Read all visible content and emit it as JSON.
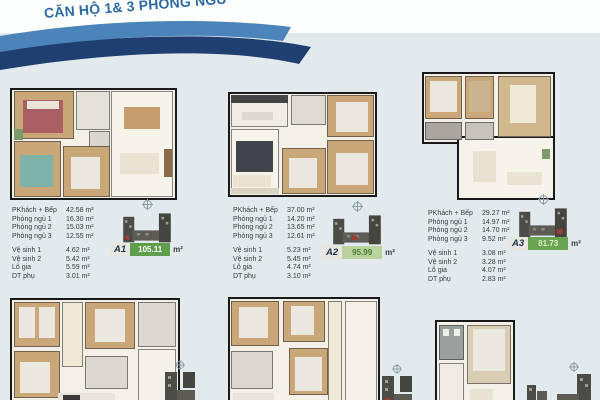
{
  "page": {
    "title": "CĂN HỘ 1& 3 PHÒNG NGỦ",
    "background": "#e2eaee",
    "title_color": "#2d6ba3",
    "ribbon_light": "#4b84ba",
    "ribbon_dark": "#1e3f70"
  },
  "units": [
    {
      "code": "A1",
      "total": "105.11",
      "unit": "m²",
      "badge_bg": "#5f9e4a",
      "badge_fg": "#ffffff",
      "specs": [
        {
          "label": "PKhách + Bếp",
          "value": "42.58 m²"
        },
        {
          "label": "Phòng ngủ 1",
          "value": "16.30 m²"
        },
        {
          "label": "Phòng ngủ 2",
          "value": "15.03 m²"
        },
        {
          "label": "Phòng ngủ 3",
          "value": "12.55 m²"
        },
        {
          "label": "Vệ sinh 1",
          "value": "4.62 m²"
        },
        {
          "label": "Vệ sinh 2",
          "value": "5.42 m²"
        },
        {
          "label": "Lô gia",
          "value": "5.59 m²"
        },
        {
          "label": "DT phụ",
          "value": "3.01 m²"
        }
      ]
    },
    {
      "code": "A2",
      "total": "95.99",
      "unit": "m²",
      "badge_bg": "#b9d29e",
      "badge_fg": "#47813a",
      "specs": [
        {
          "label": "PKhách + Bếp",
          "value": "37.00 m²"
        },
        {
          "label": "Phòng ngủ 1",
          "value": "14.20 m²"
        },
        {
          "label": "Phòng ngủ 2",
          "value": "13.65 m²"
        },
        {
          "label": "Phòng ngủ 3",
          "value": "12.61 m²"
        },
        {
          "label": "Vệ sinh 1",
          "value": "5.23 m²"
        },
        {
          "label": "Vệ sinh 2",
          "value": "5.45 m²"
        },
        {
          "label": "Lô gia",
          "value": "4.74 m²"
        },
        {
          "label": "DT phụ",
          "value": "3.10 m²"
        }
      ]
    },
    {
      "code": "A3",
      "total": "81.73",
      "unit": "m²",
      "badge_bg": "#6ba553",
      "badge_fg": "#d9ecc6",
      "specs": [
        {
          "label": "PKhách + Bếp",
          "value": "29.27 m²"
        },
        {
          "label": "Phòng ngủ 1",
          "value": "14.97 m²"
        },
        {
          "label": "Phòng ngủ 2",
          "value": "14.70 m²"
        },
        {
          "label": "Phòng ngủ 3",
          "value": "9.52 m²"
        },
        {
          "label": "Vệ sinh 1",
          "value": "3.08 m²"
        },
        {
          "label": "Vệ sinh 2",
          "value": "3.28 m²"
        },
        {
          "label": "Lô gia",
          "value": "4.07 m²"
        },
        {
          "label": "DT phụ",
          "value": "2.83 m²"
        }
      ]
    }
  ]
}
